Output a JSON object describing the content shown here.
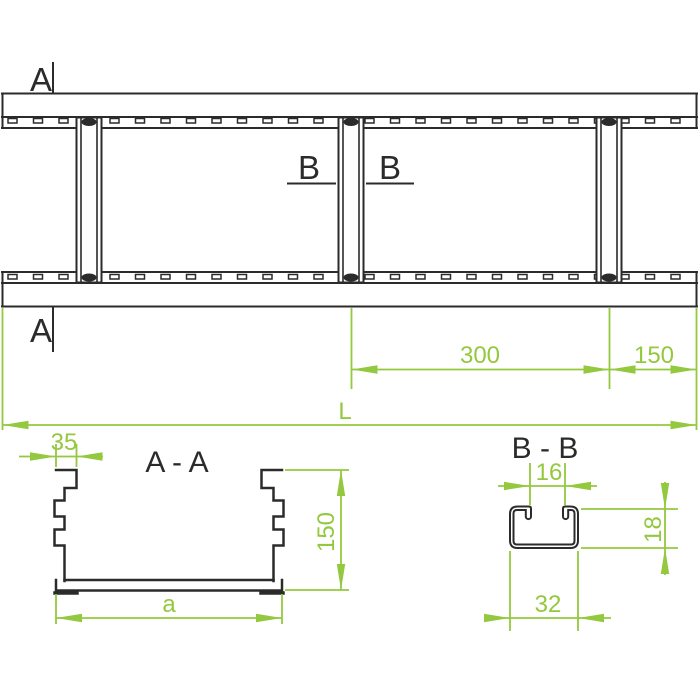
{
  "plan_view": {
    "section_label_a": "A",
    "section_label_b": "B",
    "dim_rung_spacing": "300",
    "dim_end_distance": "150",
    "dim_total_length": "L"
  },
  "section_aa": {
    "title": "A - A",
    "dim_flange_width": "35",
    "dim_side_height": "150",
    "dim_width": "a"
  },
  "section_bb": {
    "title": "B - B",
    "dim_slot_opening": "16",
    "dim_rung_height": "18",
    "dim_rung_width": "32"
  },
  "colors": {
    "dimension_green": "#94C83E",
    "line_dark": "#2B2B2B",
    "background": "#FFFFFF"
  }
}
